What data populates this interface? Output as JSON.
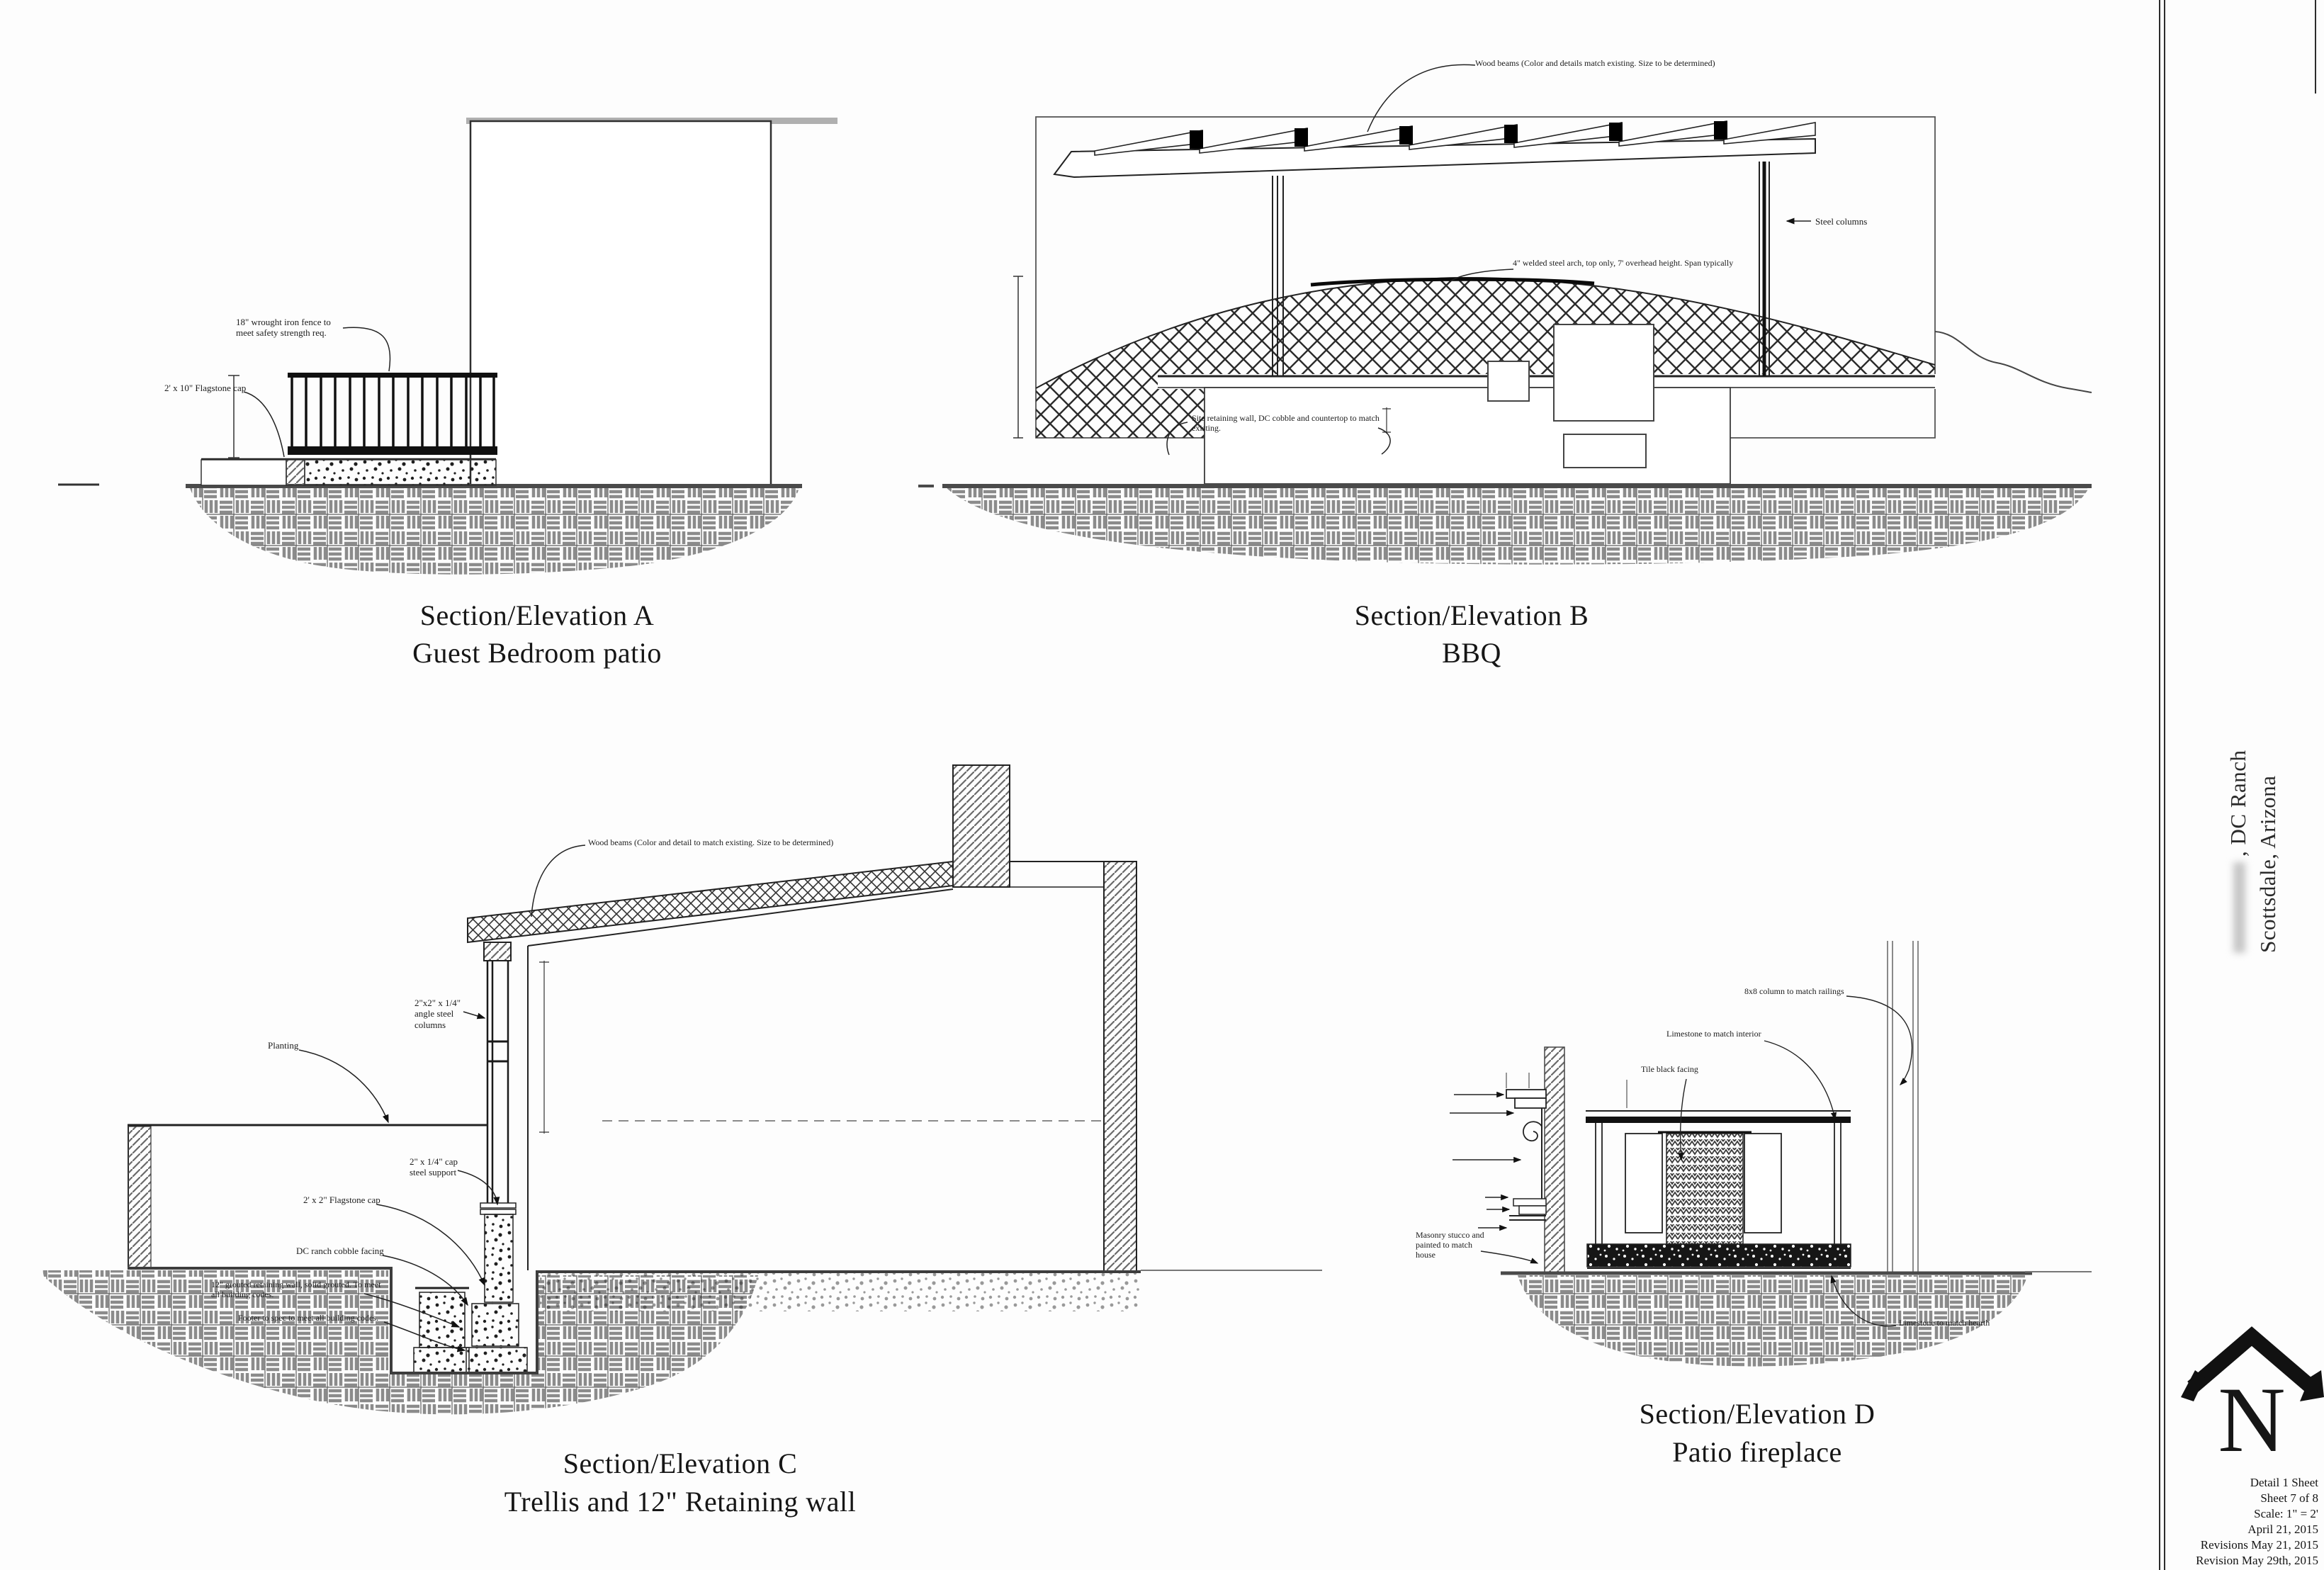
{
  "sheet": {
    "background": "#fdfdfd",
    "line_color": "#1e1e1e"
  },
  "sections": {
    "a": {
      "title_line1": "Section/Elevation A",
      "title_line2": "Guest Bedroom patio",
      "notes": {
        "fence": "18\" wrought iron fence to\nmeet safety strength req.",
        "flagstone": "2' x 10\" Flagstone cap"
      }
    },
    "b": {
      "title_line1": "Section/Elevation B",
      "title_line2": "BBQ",
      "notes": {
        "wood_beams": "Wood beams (Color and details match existing.  Size to be determined)",
        "steel_arch": "4\" welded steel arch, top only, 7' overhead height. Span typically",
        "retaining": "Site retaining wall, DC cobble and countertop to match\nexisting.",
        "columns": "Steel columns"
      }
    },
    "c": {
      "title_line1": "Section/Elevation C",
      "title_line2": "Trellis and 12\" Retaining wall",
      "notes": {
        "wood_beams": "Wood beams (Color and detail to match existing.  Size to be determined)",
        "planting": "Planting",
        "angle_columns": "2\"x2\" x 1/4\"\nangle steel\ncolumns",
        "cap_support": "2\" x 1/4\" cap\nsteel support",
        "flagstone": "2' x 2\" Flagstone cap",
        "cobble": "DC ranch cobble facing",
        "wall": "12\" grouted retaining wall, solid grouted. To meet\nall building codes.",
        "footer": "Footer to spec to meet all building codes."
      }
    },
    "d": {
      "title_line1": "Section/Elevation D",
      "title_line2": "Patio fireplace",
      "notes": {
        "column": "8x8 column to match railings",
        "limestone_top": "Limestone to match interior",
        "tile": "Tile black facing",
        "stucco": "Masonry stucco and\npainted to match\nhouse",
        "limestone_hearth": "Limestone to match hearth"
      }
    }
  },
  "titleblock": {
    "project_line1": ", DC Ranch",
    "project_line2": "Scottsdale, Arizona",
    "logo_letter": "N",
    "info_lines": [
      "Detail 1 Sheet",
      "Sheet 7 of 8",
      "Scale: 1\" = 2'",
      "April 21, 2015",
      "Revisions May 21, 2015",
      "Revision May 29th, 2015"
    ]
  }
}
